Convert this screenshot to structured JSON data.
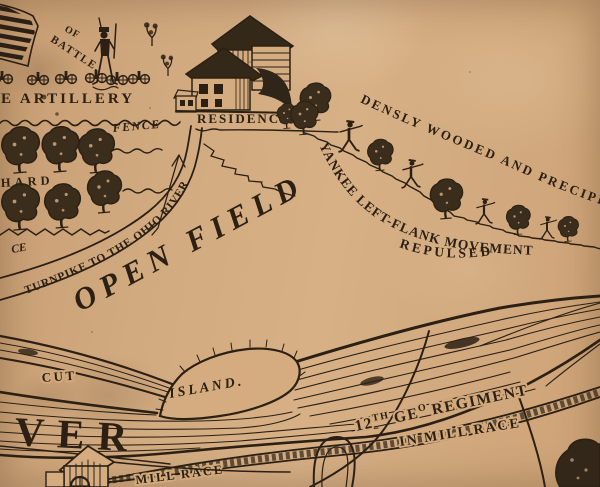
{
  "colors": {
    "paper": "#d1a87d",
    "paper_light": "#dcb88f",
    "ink": "#2b2013",
    "tree_fill": "#3b2d1c"
  },
  "symbols": {
    "flag-icon": "striped battle flag",
    "soldier-icon": "standing infantry soldier",
    "skirmisher-icon": "advancing skirmisher figure",
    "cannon-icon": "field artillery piece with two wheels",
    "tree-icon": "round deciduous tree",
    "bush-icon": "scrub bush",
    "residence-icon": "farmhouse with barn",
    "mill-icon": "mill building with waterwheel",
    "arrow-icon": "advance direction arrow"
  },
  "labels": {
    "of": "OF",
    "battle": "BATTLE.",
    "artillery": "E ARTILLERY",
    "fence_top": "FENCE",
    "residence": "RESIDENCE",
    "orchard_partial": "HARD",
    "fence_left_partial": "CE",
    "turnpike": "TURNPIKE TO THE OHIO RIVER",
    "open_field": "OPEN FIELD",
    "densly": "DENSLY WOODED AND PRECIPI",
    "yankee": "YANKEE LEFT-FLANK MOVEMENT",
    "repulsed": "REPULSED",
    "cut": "CUT",
    "island": "ISLAND.",
    "river_partial": "VER",
    "regiment_num": "12",
    "regiment_num_sup": "TH",
    "regiment_geo": "GE",
    "regiment_geo_sup": "O",
    "regiment_word": "REGIMENT",
    "in_mill_race": "IN MILL RACE",
    "mill_race": "MILL RACE"
  }
}
